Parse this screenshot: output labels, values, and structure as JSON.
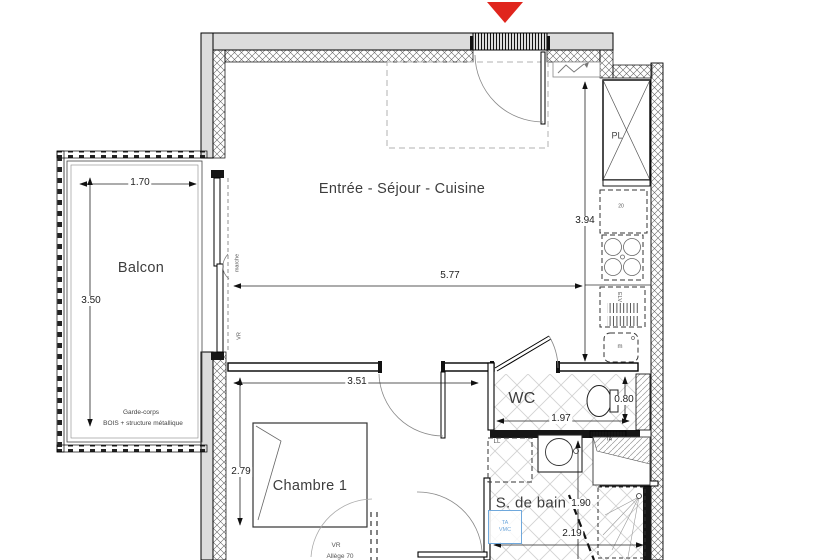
{
  "rooms": {
    "living": "Entrée - Séjour - Cuisine",
    "balcony": "Balcon",
    "bedroom": "Chambre 1",
    "wc": "WC",
    "bathroom": "S. de bain"
  },
  "dimensions": {
    "balcony_width": "1.70",
    "balcony_height": "3.50",
    "living_width": "5.77",
    "living_height": "3.94",
    "bedroom_width": "3.51",
    "bedroom_height": "2.79",
    "wc_width": "1.97",
    "wc_depth": "0.80",
    "bathroom_height": "1.90",
    "bathroom_width": "2.19"
  },
  "annotations": {
    "railing_line1": "Garde-corps",
    "railing_line2": "BOIS + structure métallique",
    "closet": "PL",
    "fridge": "20",
    "sink": "ELV",
    "appliance": "m",
    "washer": "LL",
    "duct": "TA",
    "vmc_line1": "TA",
    "vmc_line2": "VMC",
    "step": "marche",
    "shutter_bay": "VR",
    "shutter_window": "VR",
    "window_sill": "Allège 70"
  },
  "colors": {
    "entrance_arrow": "#e0251d",
    "vmc_blue": "#6fa8dc",
    "wall_fill": "#dcdcdc"
  }
}
